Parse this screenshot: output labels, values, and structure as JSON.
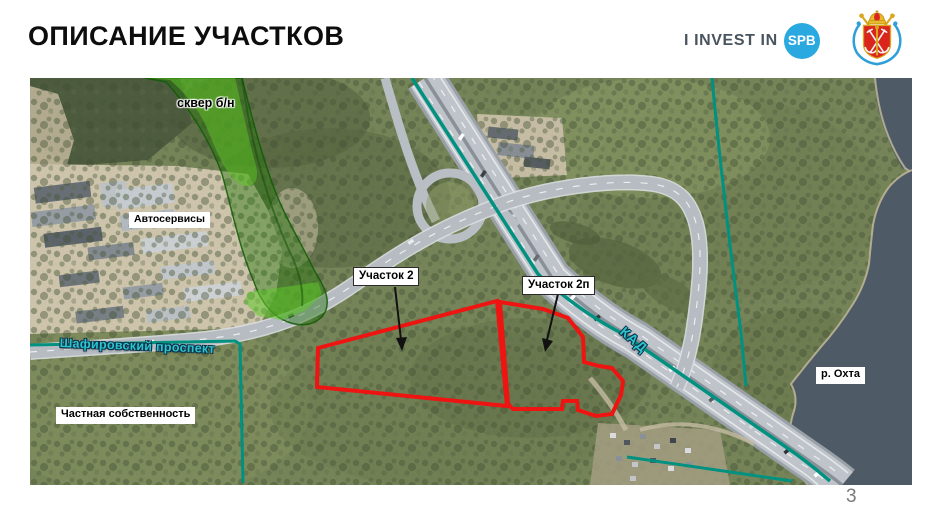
{
  "slide": {
    "title": "ОПИСАНИЕ УЧАСТКОВ",
    "page_number": "3"
  },
  "logo": {
    "text_prefix": "I INVEST IN",
    "badge": "SPB",
    "badge_color": "#29a9e0"
  },
  "map": {
    "labels": {
      "skver": "сквер б/н",
      "autoservices": "Автосервисы",
      "parcel2": "Участок 2",
      "parcel2p": "Участок 2п",
      "shafirovsky": "Шафировский проспект",
      "kad": "КАД",
      "private_property": "Частная собственность",
      "okhta_river": "р. Охта"
    },
    "colors": {
      "parcel_outline": "#ee1411",
      "boundary_line": "#009180",
      "green_zone": "#2f8f12",
      "road_label_fill": "#2cc5cf",
      "water": "#4e5a66"
    }
  }
}
